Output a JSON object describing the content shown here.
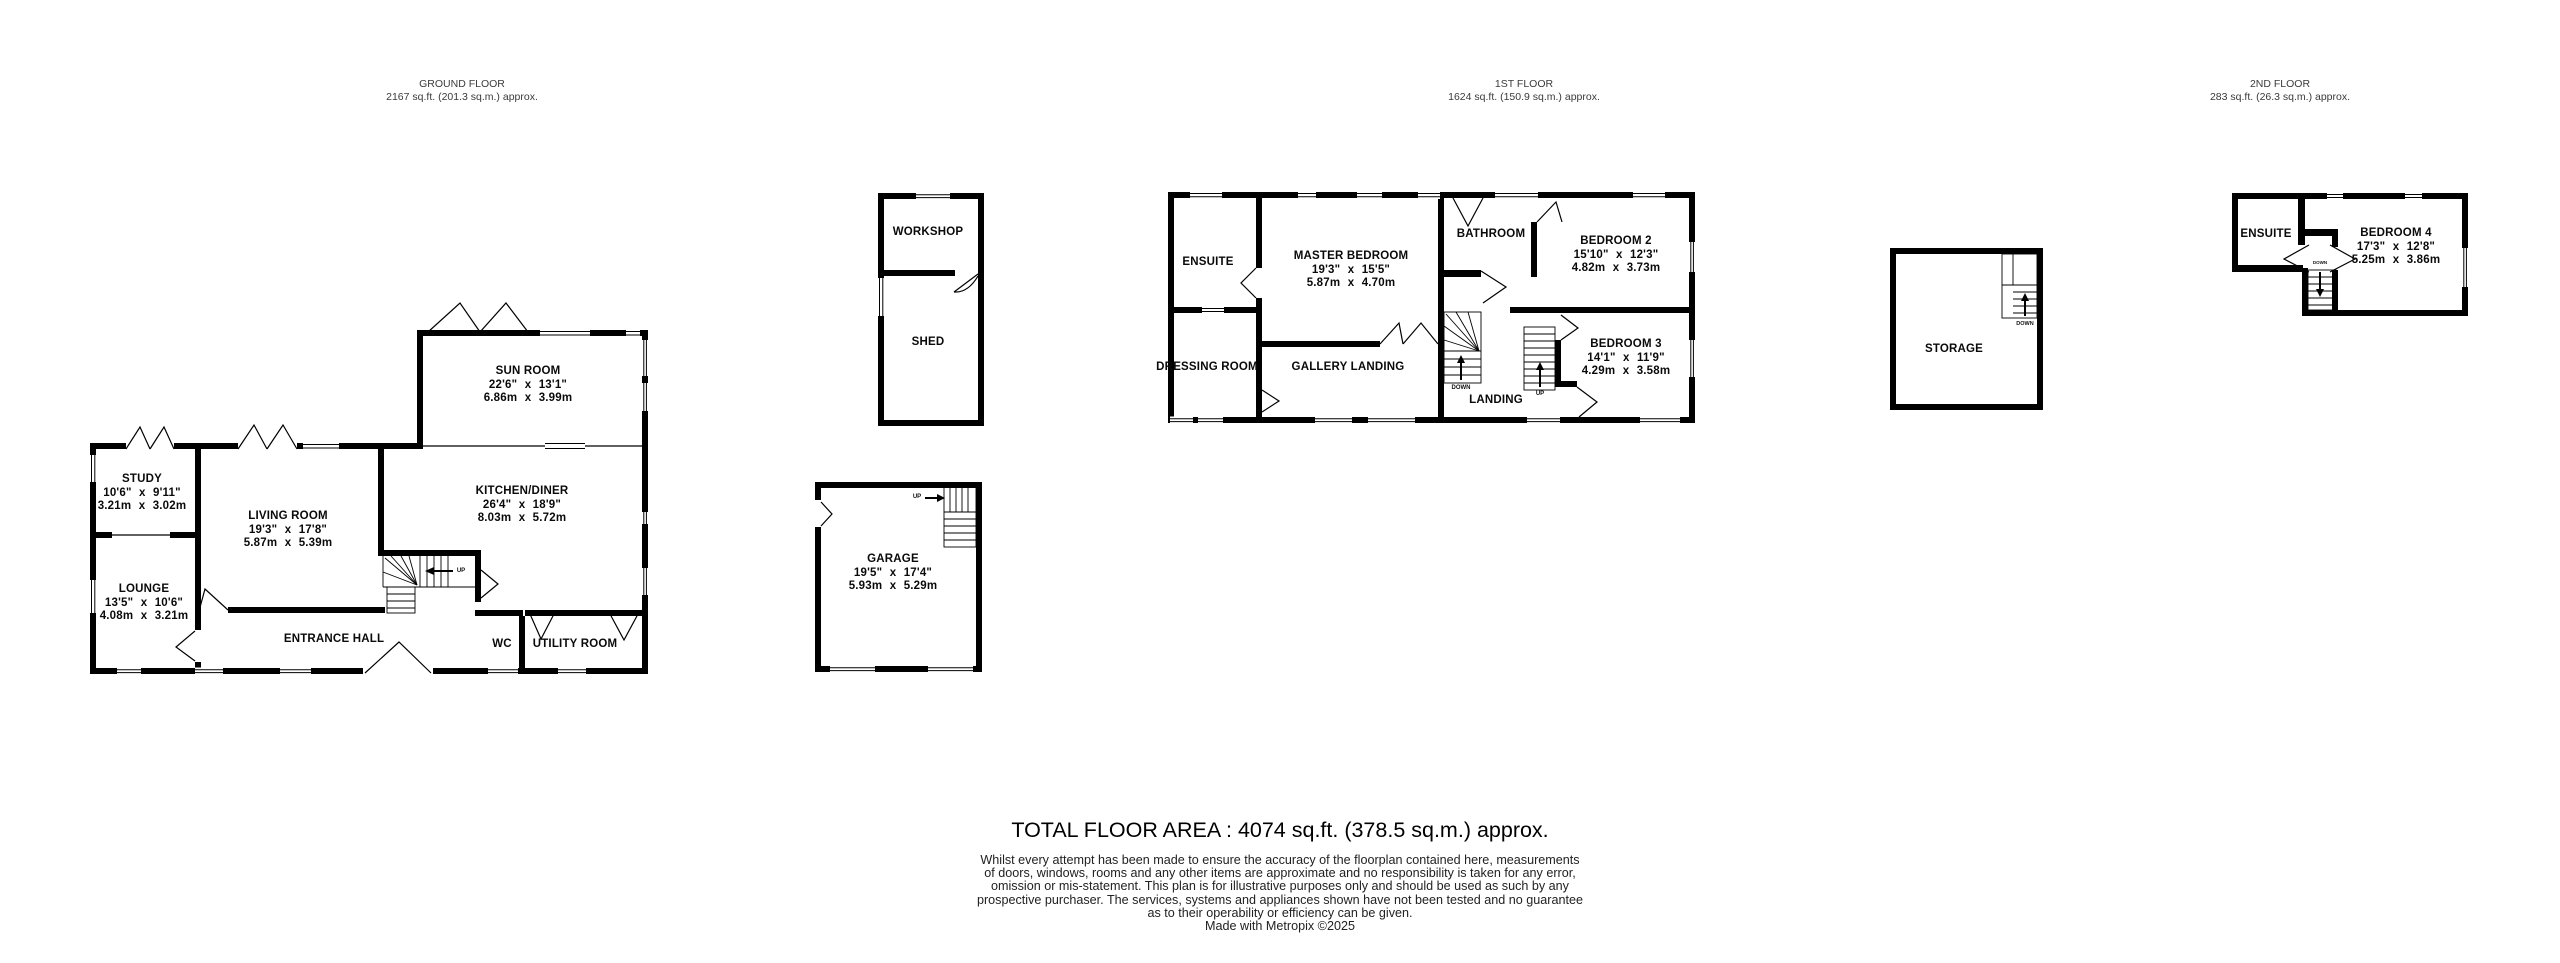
{
  "floors": {
    "ground": {
      "title": "GROUND FLOOR",
      "subtitle": "2167 sq.ft. (201.3 sq.m.) approx."
    },
    "first": {
      "title": "1ST FLOOR",
      "subtitle": "1624 sq.ft. (150.9 sq.m.) approx."
    },
    "second": {
      "title": "2ND FLOOR",
      "subtitle": "283 sq.ft. (26.3 sq.m.) approx."
    }
  },
  "rooms": {
    "study": {
      "name": "STUDY",
      "imperial": "10'6\" x 9'11\"",
      "metric": "3.21m x 3.02m"
    },
    "lounge": {
      "name": "LOUNGE",
      "imperial": "13'5\" x 10'6\"",
      "metric": "4.08m x 3.21m"
    },
    "living_room": {
      "name": "LIVING ROOM",
      "imperial": "19'3\" x 17'8\"",
      "metric": "5.87m x 5.39m"
    },
    "sun_room": {
      "name": "SUN ROOM",
      "imperial": "22'6\" x 13'1\"",
      "metric": "6.86m x 3.99m"
    },
    "kitchen_diner": {
      "name": "KITCHEN/DINER",
      "imperial": "26'4\" x 18'9\"",
      "metric": "8.03m x 5.72m"
    },
    "entrance_hall": {
      "name": "ENTRANCE HALL"
    },
    "wc": {
      "name": "WC"
    },
    "utility_room": {
      "name": "UTILITY ROOM"
    },
    "workshop": {
      "name": "WORKSHOP"
    },
    "shed": {
      "name": "SHED"
    },
    "garage": {
      "name": "GARAGE",
      "imperial": "19'5\" x 17'4\"",
      "metric": "5.93m x 5.29m"
    },
    "ensuite_first": {
      "name": "ENSUITE"
    },
    "master_bedroom": {
      "name": "MASTER BEDROOM",
      "imperial": "19'3\" x 15'5\"",
      "metric": "5.87m x 4.70m"
    },
    "dressing_room": {
      "name": "DRESSING ROOM"
    },
    "gallery_landing": {
      "name": "GALLERY LANDING"
    },
    "bathroom": {
      "name": "BATHROOM"
    },
    "bedroom2": {
      "name": "BEDROOM 2",
      "imperial": "15'10\" x 12'3\"",
      "metric": "4.82m x 3.73m"
    },
    "bedroom3": {
      "name": "BEDROOM 3",
      "imperial": "14'1\" x 11'9\"",
      "metric": "4.29m x 3.58m"
    },
    "landing": {
      "name": "LANDING"
    },
    "storage": {
      "name": "STORAGE"
    },
    "ensuite_second": {
      "name": "ENSUITE"
    },
    "bedroom4": {
      "name": "BEDROOM 4",
      "imperial": "17'3\" x 12'8\"",
      "metric": "5.25m x 3.86m"
    }
  },
  "stair_labels": {
    "up": "UP",
    "down": "DOWN"
  },
  "footer": {
    "total_area": "TOTAL FLOOR AREA : 4074 sq.ft. (378.5 sq.m.) approx.",
    "disclaimer": [
      "Whilst every attempt has been made to ensure the accuracy of the floorplan contained here, measurements",
      "of doors, windows, rooms and any other items are approximate and no responsibility is taken for any error,",
      "omission or mis-statement. This plan is for illustrative purposes only and should be used as such by any",
      "prospective purchaser. The services, systems and appliances shown have not been tested and no guarantee",
      "as to their operability or efficiency can be given."
    ],
    "credit": "Made with Metropix ©2025"
  }
}
